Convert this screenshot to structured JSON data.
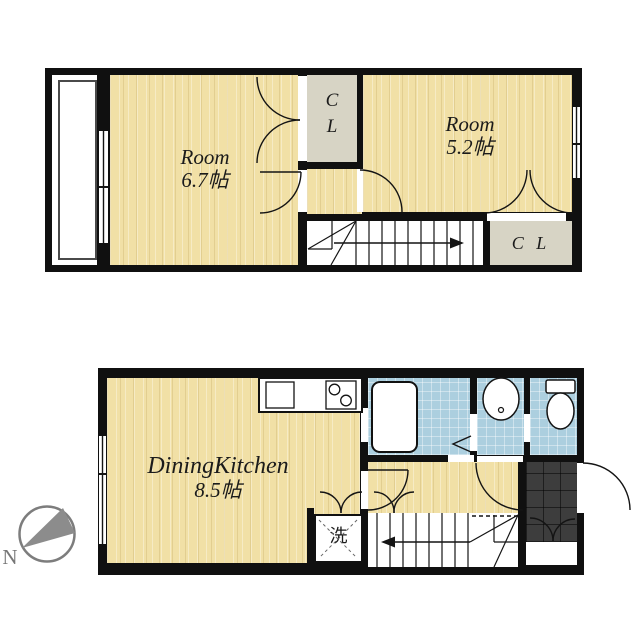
{
  "title": "2-story 1DK apartment floor plan",
  "colors": {
    "wall": "#101010",
    "wood_floor": "#f1e0a6",
    "closet": "#d7d4c5",
    "water_area": "#accfdf",
    "entrance_tile": "#3d3d3d",
    "compass_gray": "#8c8c8c"
  },
  "upper_floor": {
    "room_67": {
      "name": "Room",
      "area": "6.7帖"
    },
    "room_52": {
      "name": "Room",
      "area": "5.2帖"
    },
    "closet_top": {
      "line1": "C",
      "line2": "L"
    },
    "closet_side": {
      "label": "C L"
    }
  },
  "lower_floor": {
    "dining_kitchen": {
      "name": "DiningKitchen",
      "area": "8.5帖"
    },
    "laundry": {
      "label": "洗"
    }
  },
  "compass": {
    "label": "N"
  }
}
